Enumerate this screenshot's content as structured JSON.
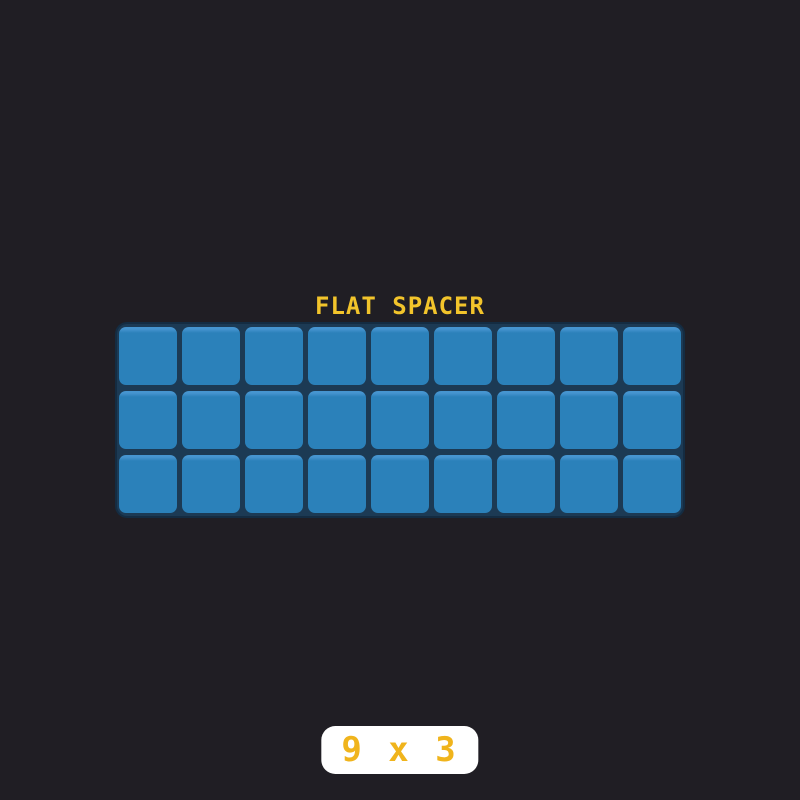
{
  "background_color": "#201e24",
  "title": {
    "text": "FLAT SPACER",
    "color": "#f2c42b"
  },
  "grid": {
    "columns": 9,
    "rows": 3,
    "tile_count": 27,
    "tile_color": "#2b81ba",
    "tile_highlight_color": "#4695d0",
    "panel_color": "#1c3a54",
    "panel_outline_color": "#142c42"
  },
  "badge": {
    "text": "9 x 3",
    "background_color": "#ffffff",
    "text_color": "#f0b41c"
  }
}
